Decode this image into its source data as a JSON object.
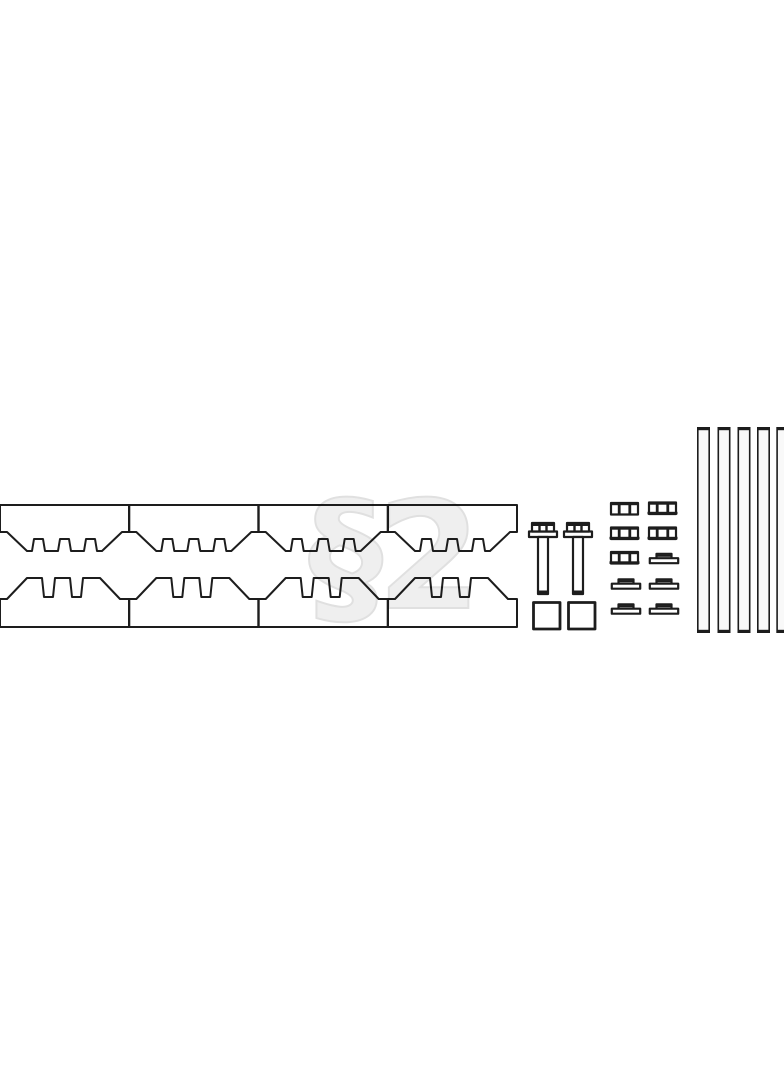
{
  "page": {
    "background": "#ffffff",
    "description": "Black-and-white exploded parts diagram of a serrated clamp / cleat mounting kit on a blank white page"
  },
  "watermark": {
    "text": "§2"
  },
  "colors": {
    "line": "#1d1d1d",
    "part-fill": "#ffffff",
    "rod-fill": "#f9f9f9",
    "wm-fill": "#efefef",
    "wm-stroke": "#e0e0e0",
    "background": "#ffffff"
  },
  "parts": {
    "upper_cleat_blocks": {
      "name": "serrated clamp block, teeth facing down",
      "quantity": 4
    },
    "lower_cleat_blocks": {
      "name": "serrated clamp block, teeth facing up",
      "quantity": 4
    },
    "flange_bolts": {
      "name": "hex flange bolt",
      "quantity": 2
    },
    "square_nuts": {
      "name": "square nut",
      "quantity": 2
    },
    "hex_nuts": {
      "name": "hex flange nut",
      "quantity": 5
    },
    "washers": {
      "name": "stepped flange washer",
      "quantity": 5
    },
    "rods": {
      "name": "threaded rod",
      "quantity": 5
    }
  }
}
